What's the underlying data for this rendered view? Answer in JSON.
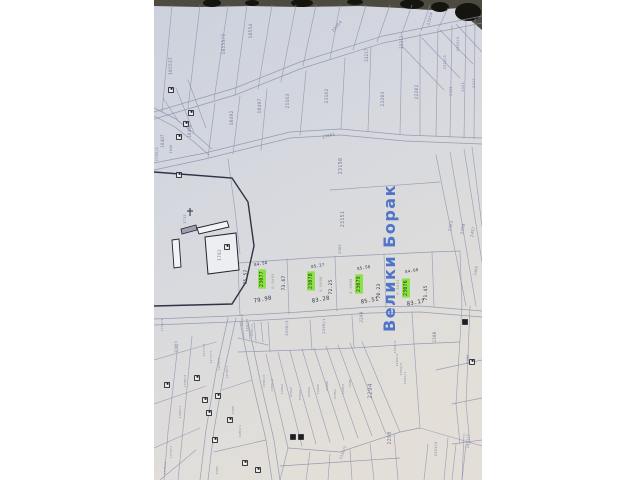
{
  "photo": {
    "paper_top": "#ccd1dd",
    "paper_mid": "#d7d9de",
    "paper_bottom": "#e3dfd8",
    "backdrop_color": "#4d4a3f",
    "backdrop_blob_color": "#15140f"
  },
  "map": {
    "place_name": "Велики Борак",
    "colors": {
      "ink": "#6b7296",
      "pen": "#2f3542",
      "pencil": "#8b8578",
      "blue": "#4f74c8",
      "highlight": "#85e23c",
      "highlight_text": "#253c0e",
      "line": "#8a90ac",
      "building": "#1d1f24"
    },
    "highlighted_parcels": [
      "23077",
      "23078",
      "23079",
      "23076"
    ],
    "labels": [
      {
        "t": "185537",
        "x": 172,
        "y": 66,
        "s": 4.5,
        "r": -90,
        "c": "ink"
      },
      {
        "t": "18553/5",
        "x": 225,
        "y": 44,
        "s": 4.5,
        "r": -90,
        "c": "ink"
      },
      {
        "t": "18554",
        "x": 252,
        "y": 31,
        "s": 4.5,
        "r": -90,
        "c": "ink"
      },
      {
        "t": "23354",
        "x": 338,
        "y": 27,
        "s": 4,
        "r": -50,
        "c": "ink"
      },
      {
        "t": "23217",
        "x": 368,
        "y": 55,
        "s": 4,
        "r": -90,
        "c": "ink"
      },
      {
        "t": "23312",
        "x": 403,
        "y": 42,
        "s": 4,
        "r": -90,
        "c": "ink"
      },
      {
        "t": "23254",
        "x": 431,
        "y": 19,
        "s": 4,
        "r": -75,
        "c": "ink"
      },
      {
        "t": "2322/1",
        "x": 446,
        "y": 62,
        "s": 3.5,
        "r": -90,
        "c": "ink"
      },
      {
        "t": "2325/4",
        "x": 459,
        "y": 44,
        "s": 3.5,
        "r": -90,
        "c": "ink"
      },
      {
        "t": "18407",
        "x": 164,
        "y": 141,
        "s": 4,
        "r": -90,
        "c": "ink"
      },
      {
        "t": "1846",
        "x": 172,
        "y": 149,
        "s": 3.2,
        "r": -90,
        "c": "ink"
      },
      {
        "t": "18498",
        "x": 191,
        "y": 131,
        "s": 4,
        "r": -90,
        "c": "ink"
      },
      {
        "t": "18492",
        "x": 233,
        "y": 118,
        "s": 4.5,
        "r": -90,
        "c": "ink"
      },
      {
        "t": "18497",
        "x": 261,
        "y": 106,
        "s": 4.5,
        "r": -90,
        "c": "ink"
      },
      {
        "t": "21163",
        "x": 289,
        "y": 101,
        "s": 4.5,
        "r": -90,
        "c": "ink"
      },
      {
        "t": "23162",
        "x": 328,
        "y": 96,
        "s": 4.5,
        "r": -90,
        "c": "ink"
      },
      {
        "t": "23203",
        "x": 384,
        "y": 99,
        "s": 4.5,
        "r": -90,
        "c": "ink"
      },
      {
        "t": "22202",
        "x": 418,
        "y": 92,
        "s": 4.5,
        "r": -90,
        "c": "ink"
      },
      {
        "t": "2322",
        "x": 452,
        "y": 91,
        "s": 3.5,
        "r": -90,
        "c": "ink"
      },
      {
        "t": "2321",
        "x": 464,
        "y": 87,
        "s": 3.5,
        "r": -90,
        "c": "ink"
      },
      {
        "t": "2317",
        "x": 475,
        "y": 83,
        "s": 3.5,
        "r": -90,
        "c": "ink"
      },
      {
        "t": "27865",
        "x": 329,
        "y": 137,
        "s": 4,
        "r": -15,
        "c": "ink"
      },
      {
        "t": "1793/1",
        "x": 158,
        "y": 154,
        "s": 3.5,
        "r": -90,
        "c": "ink"
      },
      {
        "t": "1733",
        "x": 186,
        "y": 219,
        "s": 3.5,
        "r": -90,
        "c": "ink"
      },
      {
        "t": "1782",
        "x": 221,
        "y": 255,
        "s": 4.5,
        "r": -90,
        "c": "ink"
      },
      {
        "t": "23150",
        "x": 342,
        "y": 166,
        "s": 5,
        "r": -90,
        "c": "ink"
      },
      {
        "t": "23151",
        "x": 344,
        "y": 219,
        "s": 5,
        "r": -90,
        "c": "ink"
      },
      {
        "t": "2369",
        "x": 341,
        "y": 249,
        "s": 3.5,
        "r": -90,
        "c": "ink"
      },
      {
        "t": "2361",
        "x": 452,
        "y": 226,
        "s": 4,
        "r": -80,
        "c": "ink"
      },
      {
        "t": "2458",
        "x": 464,
        "y": 229,
        "s": 4,
        "r": -80,
        "c": "ink"
      },
      {
        "t": "2457",
        "x": 474,
        "y": 232,
        "s": 4,
        "r": -80,
        "c": "ink"
      },
      {
        "t": "2468",
        "x": 477,
        "y": 271,
        "s": 3.5,
        "r": -80,
        "c": "ink"
      },
      {
        "t": "2486",
        "x": 469,
        "y": 359,
        "s": 3.5,
        "r": -90,
        "c": "ink"
      },
      {
        "t": "2493/1",
        "x": 469,
        "y": 441,
        "s": 3.5,
        "r": -90,
        "c": "ink"
      },
      {
        "t": "75.57",
        "x": 247,
        "y": 277,
        "s": 4.5,
        "r": -90,
        "c": "pen"
      },
      {
        "t": "23077",
        "x": 263,
        "y": 279,
        "s": 4.8,
        "r": -90,
        "c": "hl",
        "hl": true
      },
      {
        "t": "0.5083",
        "x": 274,
        "y": 281,
        "s": 3.8,
        "r": -90,
        "c": "pencil"
      },
      {
        "t": "73.67",
        "x": 285,
        "y": 283,
        "s": 4.5,
        "r": -90,
        "c": "pen"
      },
      {
        "t": "79.98",
        "x": 263,
        "y": 301,
        "s": 5.5,
        "r": -10,
        "c": "pen"
      },
      {
        "t": "84.58",
        "x": 261,
        "y": 265,
        "s": 4,
        "r": -10,
        "c": "pen"
      },
      {
        "t": "23078",
        "x": 312,
        "y": 281,
        "s": 4.8,
        "r": -90,
        "c": "hl",
        "hl": true
      },
      {
        "t": "0.6086",
        "x": 322,
        "y": 284,
        "s": 3.8,
        "r": -90,
        "c": "pencil"
      },
      {
        "t": "72.25",
        "x": 332,
        "y": 287,
        "s": 4.5,
        "r": -90,
        "c": "pen"
      },
      {
        "t": "83.28",
        "x": 321,
        "y": 301,
        "s": 5.5,
        "r": -10,
        "c": "pen"
      },
      {
        "t": "85.27",
        "x": 318,
        "y": 267,
        "s": 4,
        "r": -10,
        "c": "pen"
      },
      {
        "t": "23079",
        "x": 360,
        "y": 284,
        "s": 4.8,
        "r": -90,
        "c": "hl",
        "hl": true
      },
      {
        "t": "0.5085",
        "x": 352,
        "y": 286,
        "s": 3.8,
        "r": -90,
        "c": "pencil"
      },
      {
        "t": "70.23",
        "x": 380,
        "y": 291,
        "s": 4.5,
        "r": -90,
        "c": "pen"
      },
      {
        "t": "85.51",
        "x": 370,
        "y": 302,
        "s": 5.5,
        "r": -10,
        "c": "pen"
      },
      {
        "t": "85.58",
        "x": 364,
        "y": 269,
        "s": 4,
        "r": -10,
        "c": "pen"
      },
      {
        "t": "23076",
        "x": 407,
        "y": 288,
        "s": 4.8,
        "r": -90,
        "c": "hl",
        "hl": true
      },
      {
        "t": "0.5081",
        "x": 399,
        "y": 287,
        "s": 3.8,
        "r": -90,
        "c": "pencil"
      },
      {
        "t": "71.45",
        "x": 427,
        "y": 293,
        "s": 4.5,
        "r": -90,
        "c": "pen"
      },
      {
        "t": "83.17",
        "x": 416,
        "y": 304,
        "s": 5.5,
        "r": -10,
        "c": "pen"
      },
      {
        "t": "84.68",
        "x": 412,
        "y": 272,
        "s": 4,
        "r": -10,
        "c": "pen"
      },
      {
        "t": "2298/2",
        "x": 243,
        "y": 320,
        "s": 3,
        "r": -90,
        "c": "ink"
      },
      {
        "t": "2297/2",
        "x": 248,
        "y": 325,
        "s": 3,
        "r": -90,
        "c": "ink"
      },
      {
        "t": "2297/1",
        "x": 253,
        "y": 330,
        "s": 3,
        "r": -90,
        "c": "ink"
      },
      {
        "t": "2296/2",
        "x": 288,
        "y": 328,
        "s": 3.8,
        "r": -90,
        "c": "ink"
      },
      {
        "t": "2296/1",
        "x": 325,
        "y": 326,
        "s": 3.8,
        "r": -90,
        "c": "ink"
      },
      {
        "t": "2299",
        "x": 363,
        "y": 317,
        "s": 4.2,
        "r": -90,
        "c": "ink"
      },
      {
        "t": "2300",
        "x": 436,
        "y": 337,
        "s": 4.2,
        "r": -90,
        "c": "ink"
      },
      {
        "t": "2280/2",
        "x": 265,
        "y": 381,
        "s": 3,
        "r": -90,
        "c": "ink"
      },
      {
        "t": "2280/3",
        "x": 273,
        "y": 385,
        "s": 3,
        "r": -90,
        "c": "ink"
      },
      {
        "t": "22941",
        "x": 283,
        "y": 389,
        "s": 3,
        "r": -90,
        "c": "ink"
      },
      {
        "t": "22942",
        "x": 292,
        "y": 392,
        "s": 3,
        "r": -90,
        "c": "ink"
      },
      {
        "t": "22943",
        "x": 301,
        "y": 395,
        "s": 3,
        "r": -90,
        "c": "ink"
      },
      {
        "t": "22944",
        "x": 310,
        "y": 392,
        "s": 3,
        "r": -90,
        "c": "ink"
      },
      {
        "t": "22945",
        "x": 319,
        "y": 389,
        "s": 3,
        "r": -90,
        "c": "ink"
      },
      {
        "t": "22946",
        "x": 328,
        "y": 386,
        "s": 3,
        "r": -90,
        "c": "ink"
      },
      {
        "t": "22952",
        "x": 336,
        "y": 394,
        "s": 3,
        "r": -90,
        "c": "ink"
      },
      {
        "t": "22953",
        "x": 344,
        "y": 389,
        "s": 3,
        "r": -90,
        "c": "ink"
      },
      {
        "t": "2295",
        "x": 351,
        "y": 383,
        "s": 3,
        "r": -90,
        "c": "ink"
      },
      {
        "t": "2294",
        "x": 372,
        "y": 391,
        "s": 6,
        "r": -90,
        "c": "ink"
      },
      {
        "t": "2290",
        "x": 391,
        "y": 438,
        "s": 5,
        "r": -90,
        "c": "ink"
      },
      {
        "t": "2292/3",
        "x": 396,
        "y": 347,
        "s": 3,
        "r": -90,
        "c": "ink"
      },
      {
        "t": "2293/3",
        "x": 398,
        "y": 360,
        "s": 3,
        "r": -90,
        "c": "ink"
      },
      {
        "t": "2293/2",
        "x": 402,
        "y": 369,
        "s": 3,
        "r": -90,
        "c": "ink"
      },
      {
        "t": "2293/1",
        "x": 406,
        "y": 378,
        "s": 3,
        "r": -90,
        "c": "ink"
      },
      {
        "t": "2316/2",
        "x": 344,
        "y": 453,
        "s": 3.5,
        "r": -70,
        "c": "ink"
      },
      {
        "t": "2391/4",
        "x": 437,
        "y": 449,
        "s": 3.5,
        "r": -90,
        "c": "ink"
      },
      {
        "t": "1790/3",
        "x": 163,
        "y": 325,
        "s": 3,
        "r": -90,
        "c": "ink"
      },
      {
        "t": "17803",
        "x": 177,
        "y": 347,
        "s": 3.5,
        "r": -90,
        "c": "ink"
      },
      {
        "t": "1780/4",
        "x": 186,
        "y": 381,
        "s": 3,
        "r": -90,
        "c": "ink"
      },
      {
        "t": "1780/1",
        "x": 181,
        "y": 412,
        "s": 3,
        "r": -90,
        "c": "ink"
      },
      {
        "t": "1779/1",
        "x": 172,
        "y": 452,
        "s": 3,
        "r": -90,
        "c": "ink"
      },
      {
        "t": "1775/2",
        "x": 166,
        "y": 468,
        "s": 3,
        "r": -90,
        "c": "ink"
      },
      {
        "t": "2277/3",
        "x": 205,
        "y": 350,
        "s": 3,
        "r": -90,
        "c": "ink"
      },
      {
        "t": "2277/1",
        "x": 212,
        "y": 357,
        "s": 3,
        "r": -90,
        "c": "ink"
      },
      {
        "t": "2278/3",
        "x": 220,
        "y": 364,
        "s": 3,
        "r": -90,
        "c": "ink"
      },
      {
        "t": "2278/1",
        "x": 228,
        "y": 372,
        "s": 3,
        "r": -90,
        "c": "ink"
      },
      {
        "t": "2285",
        "x": 234,
        "y": 410,
        "s": 3,
        "r": -90,
        "c": "ink"
      },
      {
        "t": "2282",
        "x": 218,
        "y": 470,
        "s": 3,
        "r": -90,
        "c": "ink"
      },
      {
        "t": "2283/1",
        "x": 241,
        "y": 431,
        "s": 3,
        "r": -90,
        "c": "ink"
      }
    ],
    "houses": [
      {
        "x": 171,
        "y": 90
      },
      {
        "x": 191,
        "y": 113
      },
      {
        "x": 186,
        "y": 124
      },
      {
        "x": 179,
        "y": 137
      },
      {
        "x": 179,
        "y": 175
      },
      {
        "x": 227,
        "y": 247
      },
      {
        "x": 167,
        "y": 385
      },
      {
        "x": 197,
        "y": 378
      },
      {
        "x": 218,
        "y": 396
      },
      {
        "x": 209,
        "y": 413
      },
      {
        "x": 215,
        "y": 440
      },
      {
        "x": 245,
        "y": 463
      },
      {
        "x": 258,
        "y": 470
      },
      {
        "x": 293,
        "y": 437,
        "filled": true
      },
      {
        "x": 301,
        "y": 437,
        "filled": true
      },
      {
        "x": 465,
        "y": 322,
        "filled": true
      },
      {
        "x": 472,
        "y": 362
      },
      {
        "x": 205,
        "y": 400
      },
      {
        "x": 230,
        "y": 420
      }
    ]
  }
}
